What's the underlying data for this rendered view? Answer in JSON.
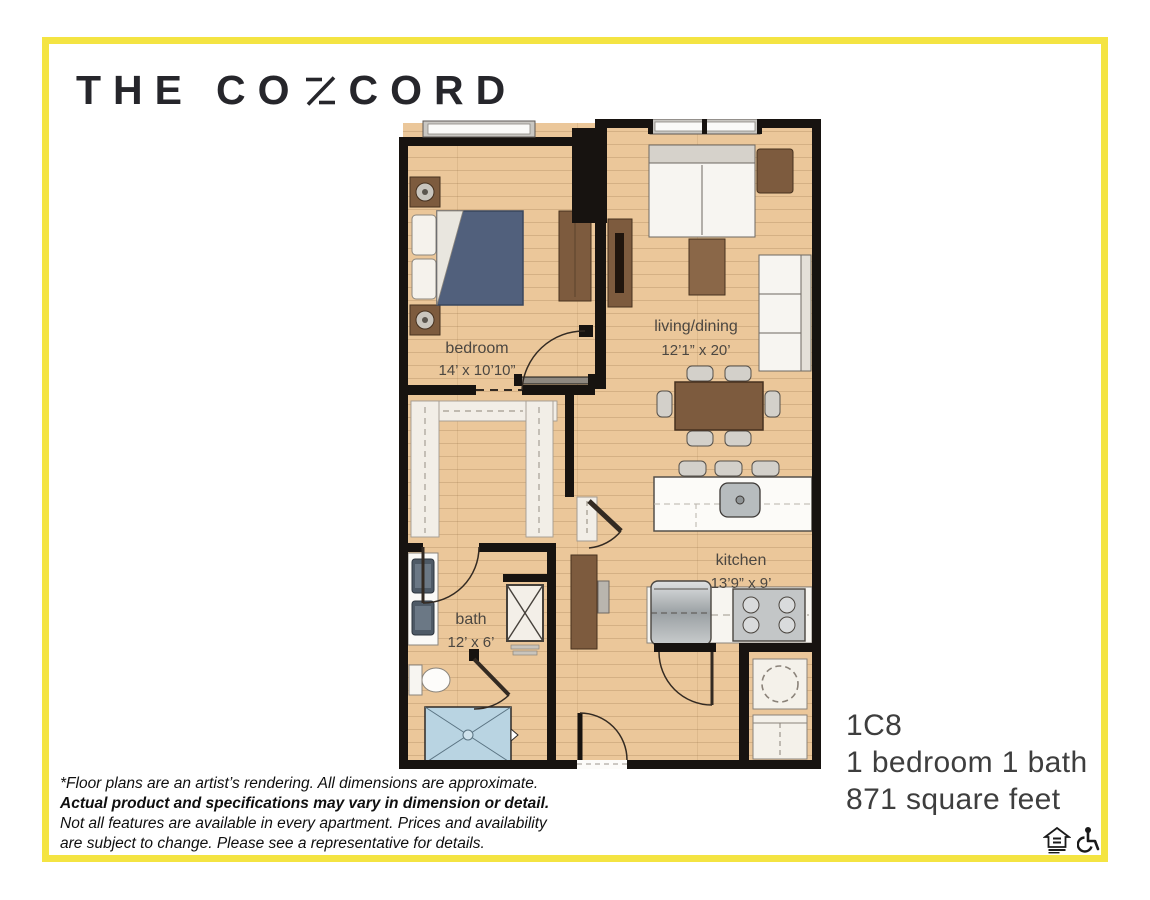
{
  "brand": {
    "word_the": "THE",
    "word_co": "CO",
    "word_cord": "CORD",
    "n_glyph": "stylized-slanted-N"
  },
  "floorplan": {
    "rooms": [
      {
        "name": "bedroom",
        "dims": "14’ x 10’10”"
      },
      {
        "name": "living/dining",
        "dims": "12’1” x 20’"
      },
      {
        "name": "kitchen",
        "dims": "13’9” x 9’"
      },
      {
        "name": "bath",
        "dims": "12’ x 6’"
      }
    ],
    "features": [
      "bed",
      "nightstands",
      "dresser",
      "sofa",
      "armchair",
      "sectional",
      "coffee-table",
      "media-unit",
      "dining-table-6-chairs",
      "kitchen-island-3-stools",
      "island-sink",
      "refrigerator",
      "range",
      "walk-in-closet-shelving",
      "double-vanity",
      "toilet",
      "shower",
      "water-heater-closet",
      "washer",
      "dryer",
      "desk",
      "entry-door"
    ]
  },
  "unit": {
    "code": "1C8",
    "layout": "1 bedroom 1 bath",
    "area": "871 square feet"
  },
  "disclaimer": {
    "line1": "*Floor plans are an artist’s rendering. All dimensions are approximate.",
    "line2": "Actual product and specifications may vary in dimension or detail.",
    "line3": "Not all features are available in every apartment. Prices and availability",
    "line4": "are subject to change. Please see a representative for details."
  },
  "icons": {
    "equal_housing": "equal-housing-opportunity-icon",
    "accessibility": "wheelchair-accessibility-icon"
  },
  "colors": {
    "frame_yellow": "#f4e442",
    "wall_black": "#171310",
    "floor_tan": "#ebc79a",
    "wood_brown": "#7d5b3e",
    "bed_navy": "#51607c",
    "shower_blue": "#b9d4e2",
    "label_gray": "#4c4741"
  }
}
